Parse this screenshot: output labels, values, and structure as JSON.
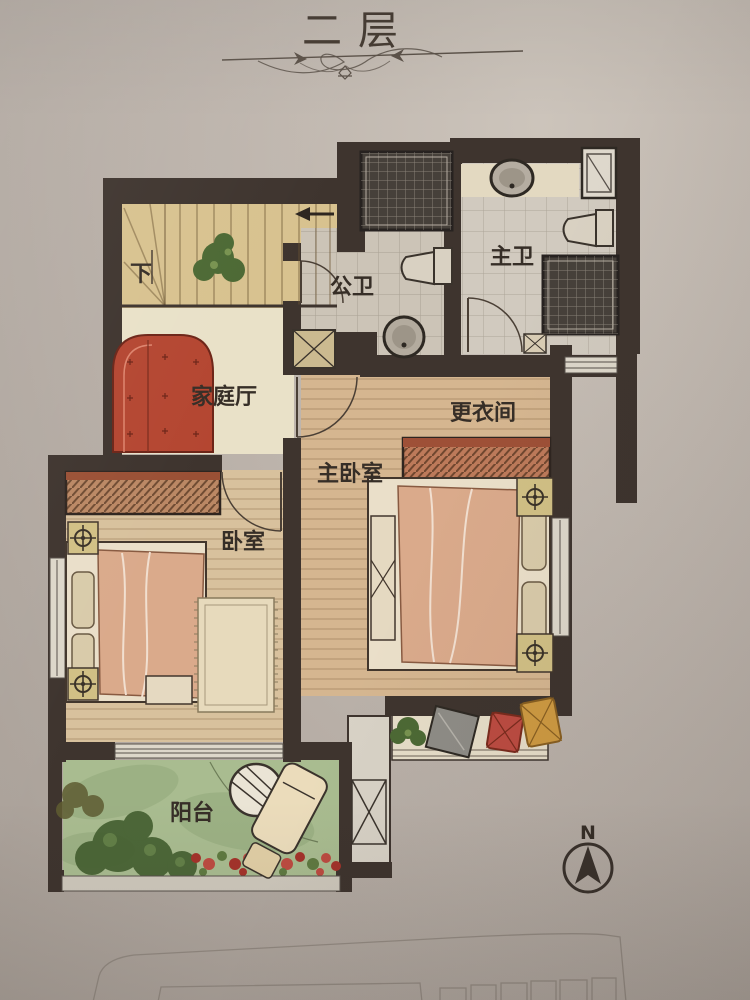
{
  "page": {
    "title": "二层"
  },
  "rooms": {
    "stairs": {
      "label": "下"
    },
    "public_bathroom": {
      "label": "公卫"
    },
    "master_bathroom": {
      "label": "主卫"
    },
    "family_hall": {
      "label": "家庭厅"
    },
    "dressing_room": {
      "label": "更衣间"
    },
    "master_bedroom": {
      "label": "主卧室"
    },
    "bedroom": {
      "label": "卧室"
    },
    "balcony": {
      "label": "阳台"
    }
  },
  "compass": {
    "north_label": "N"
  },
  "colors": {
    "wall": "#3e342e",
    "paper": "#bcb3ab",
    "stairs_floor": "#d9c28d",
    "cream_floor": "#e9e1c7",
    "tile_floor": "#cdc5b8",
    "wood_floor": "#d6b68e",
    "bedroom_floor": "#d9c19b",
    "balcony_green": "#a9bc8e",
    "accent_red": "#b8452f",
    "furniture_tan": "#bd8862"
  }
}
